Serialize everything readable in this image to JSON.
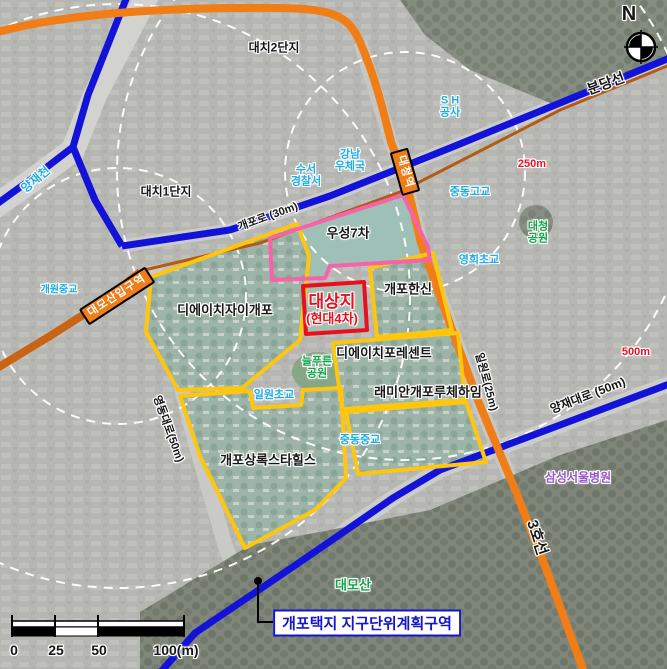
{
  "map": {
    "compass_label": "N",
    "boundary_label": "개포택지 지구단위계획구역",
    "target_site": {
      "title": "대상지",
      "subtitle": "(현대4차)"
    },
    "scale_bar": {
      "ticks": [
        "0",
        "25",
        "50",
        "100(m)"
      ]
    },
    "subway_lines": [
      "분당선",
      "3호선"
    ],
    "stations": [
      "대청역",
      "대모산입구역"
    ],
    "roads": [
      "개포로 (30m)",
      "영동대로(50m)",
      "일원로(25m)",
      "양재대로 (50m)"
    ],
    "distance_markers": [
      "250m",
      "500m"
    ],
    "labels": {
      "bundang_line": "분당선",
      "line3": "3호선",
      "daecheong_station": "대청역",
      "daemosan_ipgu_station": "대모산입구역",
      "gaepo_ro": "개포로 (30m)",
      "yeongdong_daero": "영동대로(50m)",
      "ilwon_ro": "일원로(25m)",
      "yangjae_daero": "양재대로 (50m)",
      "daechi2": "대치2단지",
      "daechi1": "대치1단지",
      "yangjae_stream": "양재천",
      "suseo_police_1": "수서",
      "suseo_police_2": "경찰서",
      "gangnam_post_1": "강남",
      "gangnam_post_2": "우체국",
      "sh_1": "S H",
      "sh_2": "공사",
      "jungdong_high": "중동고교",
      "jungdong_mid": "중동중교",
      "daecheong_park_1": "대청",
      "daecheong_park_2": "공원",
      "yeonghui_elem": "영희초교",
      "ilwon_elem": "일원초교",
      "gaewon_mid": "개원중교",
      "neulpureun_1": "늘푸른",
      "neulpureun_2": "공원",
      "daemosan": "대모산",
      "samsung_hospital": "삼성서울병원",
      "wooseong7": "우성7차",
      "gaepo_hanshin": "개포한신",
      "dh_xi_gaepo": "디에이치자이개포",
      "dh_forecent": "디에이치포레센트",
      "raemian_luchehaim": "래미안개포루체하임",
      "sangnok_stahills": "개포상록스타힐스",
      "target_title": "대상지",
      "target_sub": "(현대4차)",
      "marker_250": "250m",
      "marker_500": "500m",
      "boundary": "개포택지 지구단위계획구역",
      "compass_n": "N",
      "scale_0": "0",
      "scale_25": "25",
      "scale_50": "50",
      "scale_100": "100(m)"
    },
    "colors": {
      "line3_orange": "#f07d15",
      "suin_bundang_orange": "#c86414",
      "subway_blue": "#1212d8",
      "boundary_yellow": "#ffc60e",
      "wooseong_pink": "#f763a8",
      "target_red": "#e8101e",
      "facility_cyan": "#1fade6",
      "park_green": "#12a348",
      "distance_red": "#f01024",
      "hospital_purple": "#9a55c8",
      "district_blue": "#1515cc"
    }
  }
}
